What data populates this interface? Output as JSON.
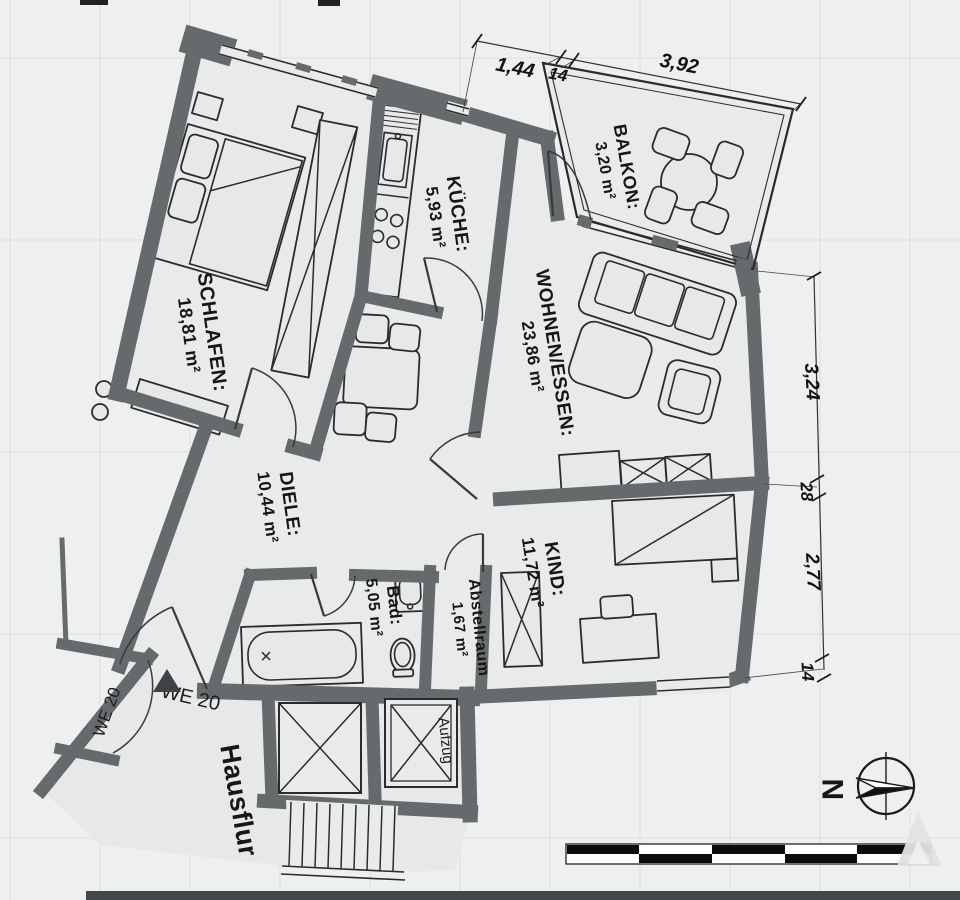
{
  "document": {
    "type": "apartment floor plan",
    "unit": "WE 20"
  },
  "rooms": {
    "schlafen": {
      "name": "SCHLAFEN:",
      "area": "18,81 m²"
    },
    "kueche": {
      "name": "KÜCHE:",
      "area": "5,93 m²"
    },
    "balkon": {
      "name": "BALKON:",
      "area": "3,20 m²"
    },
    "wohnen_essen": {
      "name": "WOHNEN/ESSEN:",
      "area": "23,86 m²"
    },
    "diele": {
      "name": "DIELE:",
      "area": "10,44 m²"
    },
    "bad": {
      "name": "Bad:",
      "area": "5,05 m²"
    },
    "abstellraum": {
      "name": "Abstellraum",
      "area": "1,67 m²"
    },
    "kind": {
      "name": "KIND:",
      "area": "11,72 m²"
    }
  },
  "annotations": {
    "hausflur": "Hausflur",
    "aufzug": "Aufzug",
    "we20_door": "WE 20",
    "we20_entry": "WE 20",
    "north_letter": "N"
  },
  "dimensions": {
    "top": [
      {
        "label": "1,44"
      },
      {
        "label": "14"
      },
      {
        "label": "3,92"
      }
    ],
    "right": [
      {
        "label": "3,24"
      },
      {
        "label": "28"
      },
      {
        "label": "2,77"
      },
      {
        "label": "14"
      }
    ]
  },
  "colors": {
    "background": "#eef0ef",
    "wall": "#666a6c",
    "room_fill": "#e9ebea",
    "outline": "#2b2b2b"
  }
}
